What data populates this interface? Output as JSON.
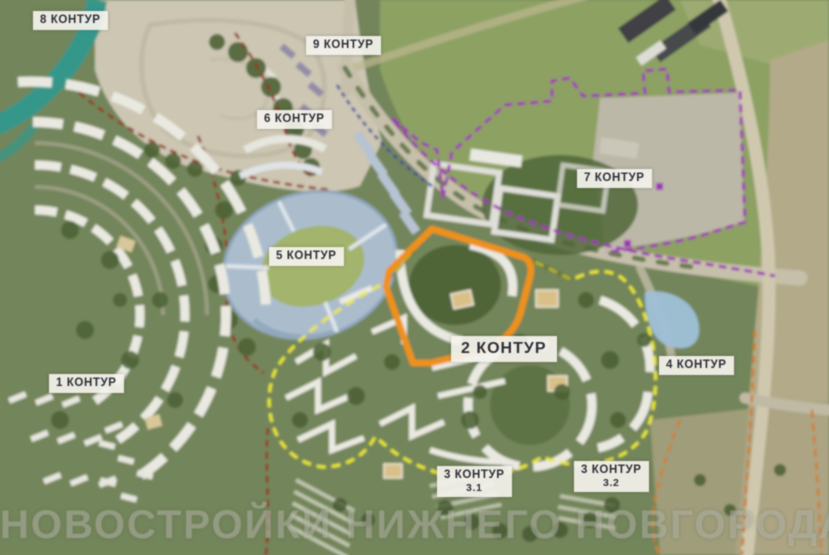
{
  "map": {
    "labels": {
      "c8": "8 КОНТУР",
      "c9": "9 КОНТУР",
      "c6": "6 КОНТУР",
      "c5": "5 КОНТУР",
      "c7": "7 КОНТУР",
      "c1": "1 КОНТУР",
      "c2": "2 КОНТУР",
      "c4": "4 КОНТУР",
      "c31_top": "3 КОНТУР",
      "c31_sub": "3.1",
      "c32_top": "3 КОНТУР",
      "c32_sub": "3.2"
    },
    "watermark": "НОВОСТРОЙКИ НИЖНЕГО НОВГОРОДА",
    "legend_colors": {
      "contour2_selected_outline": "#f09119",
      "contour23_yellow_boundary": "#e9e72f",
      "contour7_purple_boundary": "#a033b5",
      "red_dashed_boundary": "#93301f",
      "orange_dashed_boundary": "#cf7f2a",
      "blue_dashed_boundary": "#3a4f9e",
      "label_text": "#2e2e38",
      "label_background": "#f3f2ec"
    }
  }
}
